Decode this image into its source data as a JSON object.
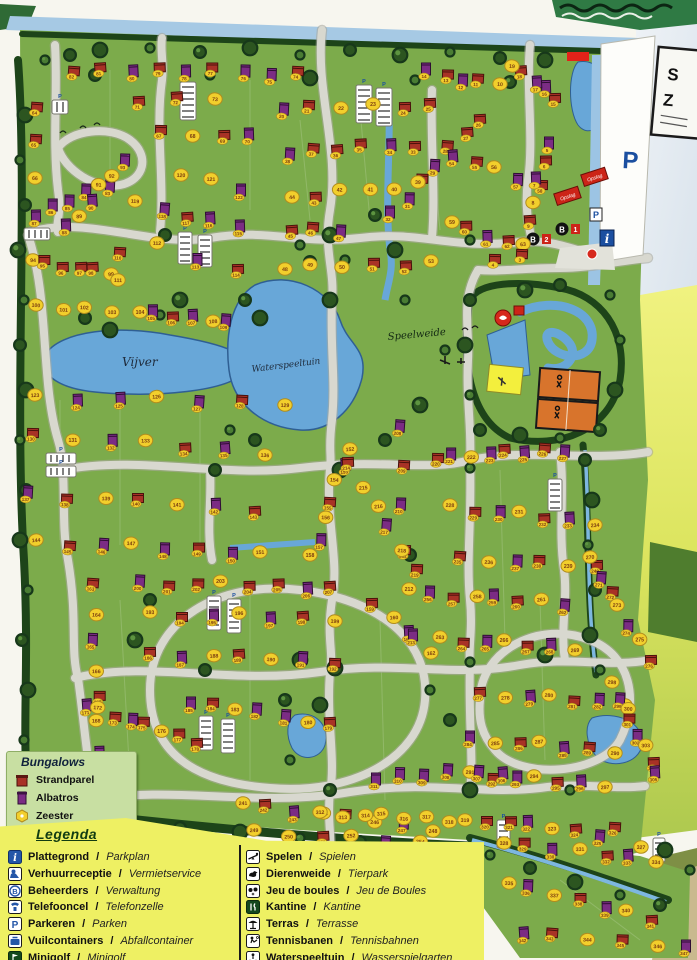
{
  "sign": {
    "line1": "S",
    "line2": "Z"
  },
  "map": {
    "labels": {
      "vijver": "Vijver",
      "waterspeeltuin": "Waterspeeltuin",
      "speelweide": "Speelweide",
      "parking_big": "P",
      "opslag": "Opslag",
      "b_letter": "B",
      "b1_num": "1",
      "b2_num": "2",
      "info": "i",
      "p_small": "P"
    },
    "colors": {
      "field": "#7cab4b",
      "hedge": "#1d4419",
      "road": "#d8d8cf",
      "water": "#68a7d8",
      "strandparel": "#a83226",
      "albatros": "#7b2c84",
      "zeester": "#f2cf2c",
      "tennis": "#d8742c",
      "legend_yellow": "#eef063"
    },
    "plot_rows": [
      [
        74,
        9,
        300,
        72,
        74,
        68,
        "SAASASASS"
      ],
      [
        71,
        3,
        140,
        100,
        212,
        97,
        "SSZ"
      ],
      [
        64,
        3,
        38,
        106,
        32,
        176,
        "SSZ"
      ],
      [
        67,
        4,
        163,
        131,
        252,
        137,
        "SZSA"
      ],
      [
        83,
        5,
        108,
        186,
        33,
        214,
        "AAAAA"
      ],
      [
        88,
        6,
        68,
        226,
        124,
        162,
        "AZAZZA"
      ],
      [
        94,
        6,
        30,
        258,
        112,
        273,
        "ZSSSSZ"
      ],
      [
        100,
        4,
        35,
        307,
        112,
        309,
        "ZZZZ"
      ],
      [
        104,
        6,
        138,
        312,
        228,
        321,
        "ZASAZA"
      ],
      [
        115,
        5,
        237,
        224,
        138,
        204,
        "AASAZ"
      ],
      [
        120,
        3,
        182,
        174,
        238,
        188,
        "ZZA"
      ],
      [
        112,
        3,
        160,
        246,
        237,
        271,
        "ZAS"
      ],
      [
        110,
        2,
        120,
        249,
        116,
        280,
        "SZ"
      ],
      [
        123,
        7,
        37,
        396,
        282,
        403,
        "ZAAZASZ"
      ],
      [
        130,
        7,
        35,
        434,
        262,
        453,
        "SZAZSAZ"
      ],
      [
        137,
        7,
        30,
        493,
        252,
        509,
        "ASZSZAS"
      ],
      [
        144,
        8,
        38,
        541,
        262,
        553,
        "ZSAZASAZ"
      ],
      [
        152,
        7,
        350,
        446,
        312,
        556,
        "ZAZSZAZ"
      ],
      [
        159,
        4,
        372,
        600,
        432,
        652,
        "SZAZ"
      ],
      [
        163,
        8,
        92,
        585,
        102,
        779,
        "SZAZSZAS"
      ],
      [
        171,
        8,
        84,
        703,
        194,
        741,
        "AZSASZSS"
      ],
      [
        179,
        7,
        332,
        723,
        188,
        701,
        "SZAAZSA"
      ],
      [
        186,
        7,
        152,
        653,
        332,
        661,
        "SAZSZAS"
      ],
      [
        193,
        7,
        152,
        613,
        332,
        619,
        "ZSAZASZ"
      ],
      [
        200,
        8,
        142,
        582,
        332,
        587,
        "ASSZSSAS"
      ],
      [
        208,
        6,
        400,
        423,
        410,
        633,
        "ASASZA"
      ],
      [
        214,
        6,
        350,
        463,
        416,
        571,
        "SZZAZS"
      ],
      [
        220,
        8,
        435,
        456,
        562,
        449,
        "SAZASASA"
      ],
      [
        228,
        7,
        452,
        506,
        592,
        523,
        "ZSAZSAZ"
      ],
      [
        235,
        6,
        462,
        557,
        596,
        567,
        "SZASZS"
      ],
      [
        241,
        8,
        240,
        801,
        430,
        829,
        "ZSAZSZAZ"
      ],
      [
        249,
        7,
        256,
        831,
        452,
        846,
        "ZZSZAZS"
      ],
      [
        256,
        7,
        432,
        593,
        562,
        603,
        "ASZASZA"
      ],
      [
        263,
        7,
        442,
        638,
        572,
        648,
        "ZSAZSAZ"
      ],
      [
        270,
        7,
        592,
        558,
        648,
        658,
        "ZASZAZS"
      ],
      [
        277,
        7,
        482,
        693,
        622,
        703,
        "SZAZSAZ"
      ],
      [
        284,
        7,
        472,
        738,
        612,
        751,
        "AZSZASZ"
      ],
      [
        291,
        7,
        472,
        773,
        602,
        785,
        "ZSAZSAZ"
      ],
      [
        298,
        8,
        614,
        683,
        657,
        773,
        "ZAZSAZSA"
      ],
      [
        306,
        6,
        503,
        770,
        373,
        777,
        "AAAAAA"
      ],
      [
        312,
        8,
        322,
        813,
        467,
        821,
        "ZZZZZZZZ"
      ],
      [
        320,
        6,
        487,
        818,
        597,
        834,
        "SSAZSA"
      ],
      [
        326,
        2,
        617,
        828,
        641,
        844,
        "SZ"
      ],
      [
        328,
        7,
        502,
        843,
        656,
        859,
        "ZSAZSAZ"
      ],
      [
        335,
        7,
        507,
        883,
        652,
        917,
        "ZAZSAZS"
      ],
      [
        342,
        6,
        522,
        933,
        688,
        947,
        "ASZSZA"
      ],
      [
        20,
        6,
        282,
        109,
        432,
        104,
        "ASZZSS"
      ],
      [
        26,
        7,
        480,
        116,
        392,
        213,
        "SSSASAA"
      ],
      [
        33,
        6,
        415,
        143,
        287,
        152,
        "SASSSA"
      ],
      [
        39,
        6,
        420,
        183,
        291,
        199,
        "ZZZZSZ"
      ],
      [
        45,
        3,
        289,
        228,
        341,
        228,
        "SSA"
      ],
      [
        48,
        6,
        283,
        269,
        433,
        262,
        "ZZZSSZ"
      ],
      [
        54,
        5,
        453,
        153,
        541,
        187,
        "ASZAS"
      ],
      [
        59,
        5,
        449,
        220,
        526,
        247,
        "ZSASZ"
      ],
      [
        10,
        5,
        497,
        82,
        429,
        72,
        "ZSASA"
      ],
      [
        15,
        5,
        556,
        97,
        512,
        63,
        "SAASZ"
      ],
      [
        5,
        5,
        549,
        140,
        529,
        222,
        "ASAZS"
      ],
      [
        3,
        2,
        519,
        252,
        497,
        260,
        "SS"
      ]
    ],
    "trees": [
      [
        45,
        60
      ],
      [
        70,
        55
      ],
      [
        100,
        50
      ],
      [
        150,
        48
      ],
      [
        200,
        52
      ],
      [
        250,
        48
      ],
      [
        300,
        55
      ],
      [
        350,
        50
      ],
      [
        400,
        55
      ],
      [
        450,
        52
      ],
      [
        500,
        58
      ],
      [
        545,
        60
      ],
      [
        210,
        75
      ],
      [
        95,
        75
      ],
      [
        310,
        78
      ],
      [
        415,
        80
      ],
      [
        510,
        82
      ],
      [
        25,
        115
      ],
      [
        20,
        160
      ],
      [
        25,
        205
      ],
      [
        18,
        250
      ],
      [
        24,
        300
      ],
      [
        20,
        345
      ],
      [
        26,
        390
      ],
      [
        20,
        440
      ],
      [
        26,
        490
      ],
      [
        20,
        540
      ],
      [
        28,
        590
      ],
      [
        22,
        640
      ],
      [
        28,
        690
      ],
      [
        24,
        740
      ],
      [
        30,
        790
      ],
      [
        70,
        815
      ],
      [
        120,
        822
      ],
      [
        180,
        828
      ],
      [
        240,
        832
      ],
      [
        300,
        838
      ],
      [
        360,
        842
      ],
      [
        420,
        845
      ],
      [
        60,
        760
      ],
      [
        245,
        300
      ],
      [
        260,
        318
      ],
      [
        300,
        245
      ],
      [
        310,
        262
      ],
      [
        180,
        300
      ],
      [
        160,
        315
      ],
      [
        85,
        318
      ],
      [
        110,
        330
      ],
      [
        230,
        430
      ],
      [
        255,
        440
      ],
      [
        330,
        300
      ],
      [
        345,
        260
      ],
      [
        375,
        215
      ],
      [
        395,
        250
      ],
      [
        405,
        300
      ],
      [
        385,
        440
      ],
      [
        420,
        405
      ],
      [
        445,
        350
      ],
      [
        470,
        300
      ],
      [
        465,
        345
      ],
      [
        470,
        395
      ],
      [
        480,
        430
      ],
      [
        520,
        435
      ],
      [
        560,
        438
      ],
      [
        600,
        430
      ],
      [
        615,
        390
      ],
      [
        620,
        340
      ],
      [
        560,
        285
      ],
      [
        525,
        290
      ],
      [
        610,
        295
      ],
      [
        585,
        460
      ],
      [
        592,
        500
      ],
      [
        588,
        545
      ],
      [
        595,
        590
      ],
      [
        590,
        635
      ],
      [
        600,
        670
      ],
      [
        285,
        700
      ],
      [
        320,
        705
      ],
      [
        290,
        760
      ],
      [
        150,
        600
      ],
      [
        135,
        640
      ],
      [
        430,
        690
      ],
      [
        450,
        720
      ],
      [
        300,
        660
      ],
      [
        490,
        855
      ],
      [
        530,
        868
      ],
      [
        575,
        882
      ],
      [
        620,
        895
      ],
      [
        660,
        905
      ],
      [
        665,
        850
      ],
      [
        690,
        870
      ],
      [
        165,
        235
      ],
      [
        330,
        235
      ],
      [
        470,
        240
      ],
      [
        215,
        470
      ],
      [
        340,
        470
      ],
      [
        470,
        468
      ],
      [
        205,
        670
      ],
      [
        335,
        668
      ],
      [
        470,
        662
      ],
      [
        330,
        790
      ],
      [
        470,
        790
      ],
      [
        570,
        790
      ],
      [
        410,
        555
      ],
      [
        545,
        655
      ]
    ],
    "parkings": [
      [
        180,
        82,
        16,
        38
      ],
      [
        356,
        85,
        16,
        38
      ],
      [
        376,
        88,
        16,
        38
      ],
      [
        52,
        100,
        16,
        14
      ],
      [
        24,
        228,
        26,
        12
      ],
      [
        178,
        232,
        14,
        32
      ],
      [
        198,
        235,
        14,
        32
      ],
      [
        46,
        453,
        30,
        11
      ],
      [
        46,
        466,
        30,
        11
      ],
      [
        207,
        596,
        14,
        34
      ],
      [
        227,
        599,
        14,
        34
      ],
      [
        199,
        716,
        14,
        34
      ],
      [
        221,
        719,
        14,
        34
      ],
      [
        548,
        479,
        14,
        32
      ],
      [
        497,
        820,
        13,
        28
      ],
      [
        653,
        838,
        12,
        24
      ]
    ]
  },
  "bungalows_box": {
    "title": "Bungalows",
    "items": [
      {
        "label": "Strandparel",
        "type": "S"
      },
      {
        "label": "Albatros",
        "type": "A"
      },
      {
        "label": "Zeester",
        "type": "Z"
      }
    ]
  },
  "legend": {
    "title": "Legenda",
    "columns": [
      [
        {
          "nl": "Plattegrond",
          "de": "Parkplan",
          "icon": "info"
        },
        {
          "nl": "Verhuurreceptie",
          "de": "Vermietservice",
          "icon": "reception"
        },
        {
          "nl": "Beheerders",
          "de": "Verwaltung",
          "icon": "beheerders"
        },
        {
          "nl": "Telefooncel",
          "de": "Telefonzelle",
          "icon": "telefoon"
        },
        {
          "nl": "Parkeren",
          "de": "Parken",
          "icon": "parkeren"
        },
        {
          "nl": "Vuilcontainers",
          "de": "Abfallcontainer",
          "icon": "vuilcontainer"
        },
        {
          "nl": "Minigolf",
          "de": "Minigolf",
          "icon": "minigolf"
        }
      ],
      [
        {
          "nl": "Spelen",
          "de": "Spielen",
          "icon": "spelen"
        },
        {
          "nl": "Dierenweide",
          "de": "Tierpark",
          "icon": "dierenweide"
        },
        {
          "nl": "Jeu de boules",
          "de": "Jeu de Boules",
          "icon": "jeudeboules"
        },
        {
          "nl": "Kantine",
          "de": "Kantine",
          "icon": "kantine"
        },
        {
          "nl": "Terras",
          "de": "Terrasse",
          "icon": "terras"
        },
        {
          "nl": "Tennisbanen",
          "de": "Tennisbahnen",
          "icon": "tennis"
        },
        {
          "nl": "Waterspeeltuin",
          "de": "Wasserspielgarten",
          "icon": "waterspeeltuin"
        }
      ]
    ]
  }
}
